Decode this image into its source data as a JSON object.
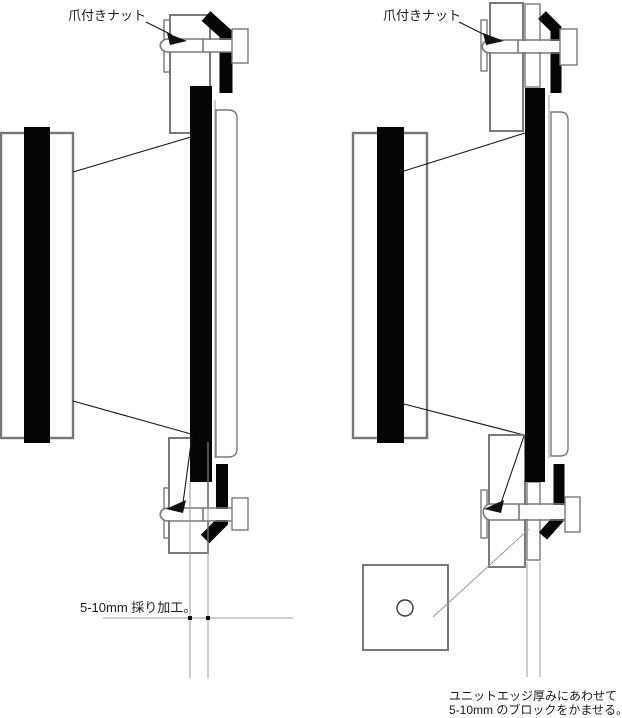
{
  "left_view": {
    "tee_nut_label": "爪付きナット",
    "recess_note": "5-10mm 採り加工。"
  },
  "right_view": {
    "tee_nut_label": "爪付きナット",
    "block_note_line1": "ユニットエッジ厚みにあわせて",
    "block_note_line2": "5-10mm のブロックをかませる。"
  },
  "colors": {
    "background": "#ffffff",
    "ink_black": "#050505",
    "outline_gray": "#7a7a7a",
    "leader_line": "#1a1a1a",
    "guide_gray": "#9b9b9b",
    "text": "#1a1a1a"
  }
}
